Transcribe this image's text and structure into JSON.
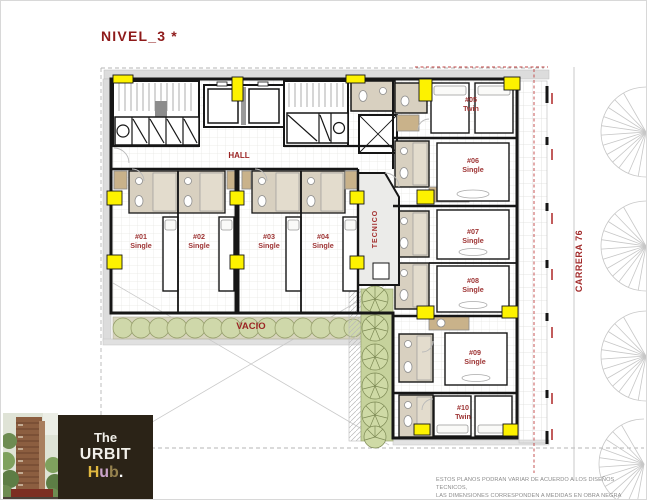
{
  "title": "NIVEL_3 *",
  "plan": {
    "hall_label": "HALL",
    "tecnico_label": "TECNICO",
    "vacio_label": "VACIO",
    "street_label": "CARRERA 76",
    "rooms": [
      {
        "number": "#01",
        "type": "Single"
      },
      {
        "number": "#02",
        "type": "Single"
      },
      {
        "number": "#03",
        "type": "Single"
      },
      {
        "number": "#04",
        "type": "Single"
      },
      {
        "number": "#05",
        "type": "Twin"
      },
      {
        "number": "#06",
        "type": "Single"
      },
      {
        "number": "#07",
        "type": "Single"
      },
      {
        "number": "#08",
        "type": "Single"
      },
      {
        "number": "#09",
        "type": "Single"
      },
      {
        "number": "#10",
        "type": "Twin"
      }
    ]
  },
  "logo": {
    "line1": "The",
    "line2": "URBIT",
    "hub_h": "H",
    "hub_u": "u",
    "hub_b": "b",
    "hub_dot": "."
  },
  "disclaimer": {
    "line1": "ESTOS PLANOS PODRAN VARIAR DE ACUERDO A LOS DISEÑOS TECNICOS,",
    "line2": "LAS DIMENSIONES CORRESPONDEN A MEDIDAS EN OBRA NEGRA"
  },
  "colors": {
    "accent_red": "#9b2424",
    "room_label_red": "#9e3535",
    "marker_yellow": "#fdf200",
    "wall_black": "#161616",
    "planter_green": "#ccd6a0",
    "logo_bg": "#2b2317",
    "hub_h": "#e0b83f",
    "hub_u": "#c9a3c9",
    "hub_b": "#96824e"
  }
}
